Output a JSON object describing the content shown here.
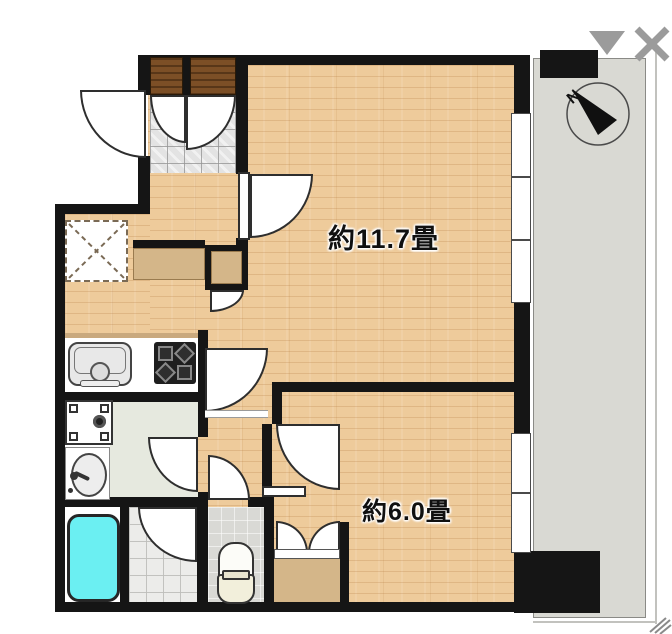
{
  "viewer": {
    "controls": {
      "collapse": {
        "icon": "triangle-down-icon",
        "color": "#9b9b9b"
      },
      "close": {
        "icon": "close-x-icon",
        "color": "#9b9b9b"
      }
    }
  },
  "floorplan": {
    "rooms": [
      {
        "id": "living-dining-kitchen",
        "label": "約11.7畳"
      },
      {
        "id": "bedroom",
        "label": "約6.0畳"
      }
    ],
    "compass": {
      "label": "N"
    },
    "features": [
      "entrance",
      "shoe-cabinet",
      "refrigerator-space",
      "kitchen-counter",
      "sink",
      "stove",
      "washing-machine-pan",
      "washbasin",
      "bathtub",
      "bathroom",
      "toilet",
      "closet",
      "balcony"
    ],
    "colors": {
      "wood_floor": "#eecb9b",
      "wall": "#151515",
      "balcony": "#d9d9d3",
      "bathtub": "#6beff2",
      "entrance_tile": "#e3e3e3",
      "door_panel": "#7c4f26",
      "washroom_floor": "#e6e9df"
    }
  }
}
